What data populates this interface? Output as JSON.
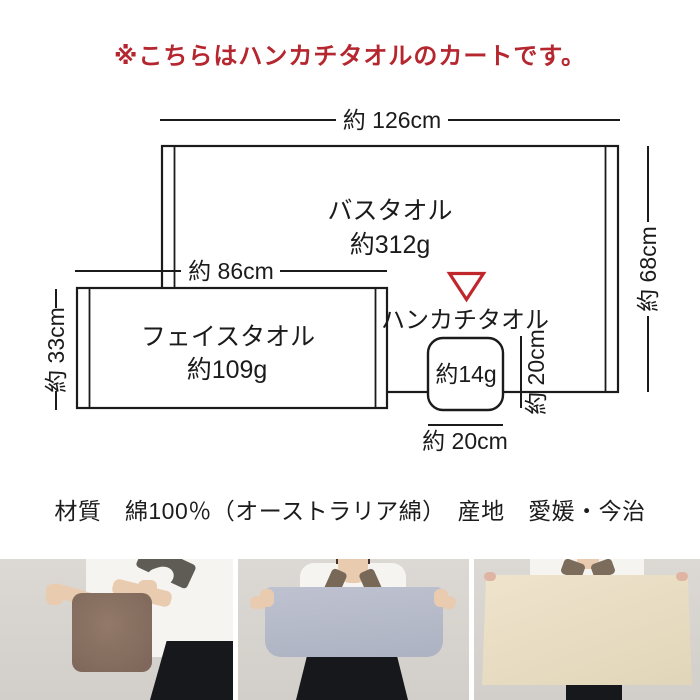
{
  "notice": {
    "text": "※こちらはハンカチタオルのカートです。",
    "color": "#b5262f"
  },
  "diagram": {
    "line_color": "#1b1b1b",
    "marker_color": "#c0272d",
    "bath_towel": {
      "label": "バスタオル",
      "weight": "約312g",
      "width": "約 126cm",
      "height": "約 68cm"
    },
    "face_towel": {
      "label": "フェイスタオル",
      "weight": "約109g",
      "width": "約 86cm",
      "height": "約 33cm"
    },
    "hand_towel": {
      "label": "ハンカチタオル",
      "weight": "約14g",
      "width": "約 20cm",
      "height": "約 20cm"
    }
  },
  "specs": {
    "text": "材質　綿100％（オーストラリア綿）　産地　愛媛・今治"
  },
  "photos": {
    "wall_color": "#d9d5d0",
    "items": [
      {
        "id": "hand-towel-photo",
        "towel_color": "#8b7264"
      },
      {
        "id": "face-towel-photo",
        "towel_color": "#b7bbc9"
      },
      {
        "id": "bath-towel-photo",
        "towel_color": "#e9dec5"
      }
    ]
  }
}
